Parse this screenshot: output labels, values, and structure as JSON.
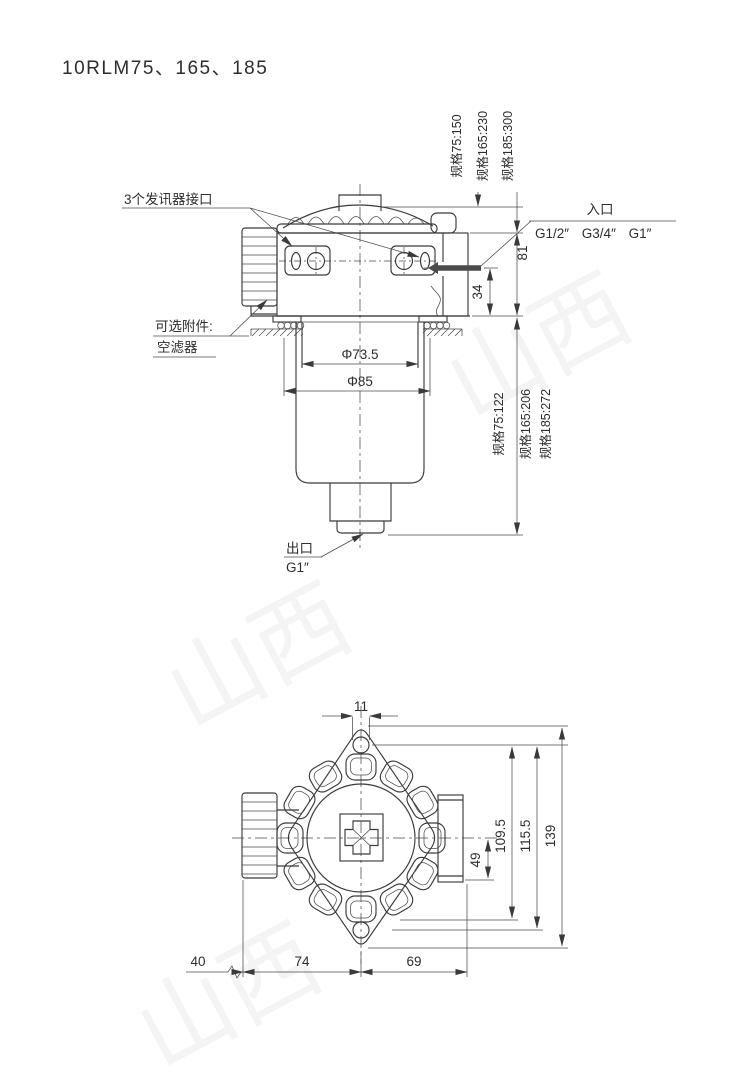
{
  "title": "10RLM75、165、185",
  "watermark": "山西",
  "front_view": {
    "callouts": {
      "sensor_ports": "3个发讯器接口",
      "optional_accessory_title": "可选附件:",
      "optional_accessory_item": "空滤器",
      "inlet_label": "入口",
      "inlet_threads": "G1/2″ G3/4″ G1″",
      "outlet_label": "出口",
      "outlet_thread": "G1″"
    },
    "dimensions": {
      "inner_diameter": "Φ73.5",
      "outer_diameter": "Φ85",
      "inlet_height": "81",
      "inlet_offset": "34",
      "head_height_specs": [
        "规格75:150",
        "规格165:230",
        "规格185:300"
      ],
      "bowl_height_specs": [
        "规格75:122",
        "规格165:206",
        "规格185:272"
      ]
    }
  },
  "bottom_view": {
    "dimensions": {
      "slot_width": "11",
      "port_offset": "49",
      "bolt_span": "109.5",
      "body_span": "115.5",
      "overall_height": "139",
      "left_offset": "40",
      "left_span": "74",
      "right_span": "69"
    }
  }
}
